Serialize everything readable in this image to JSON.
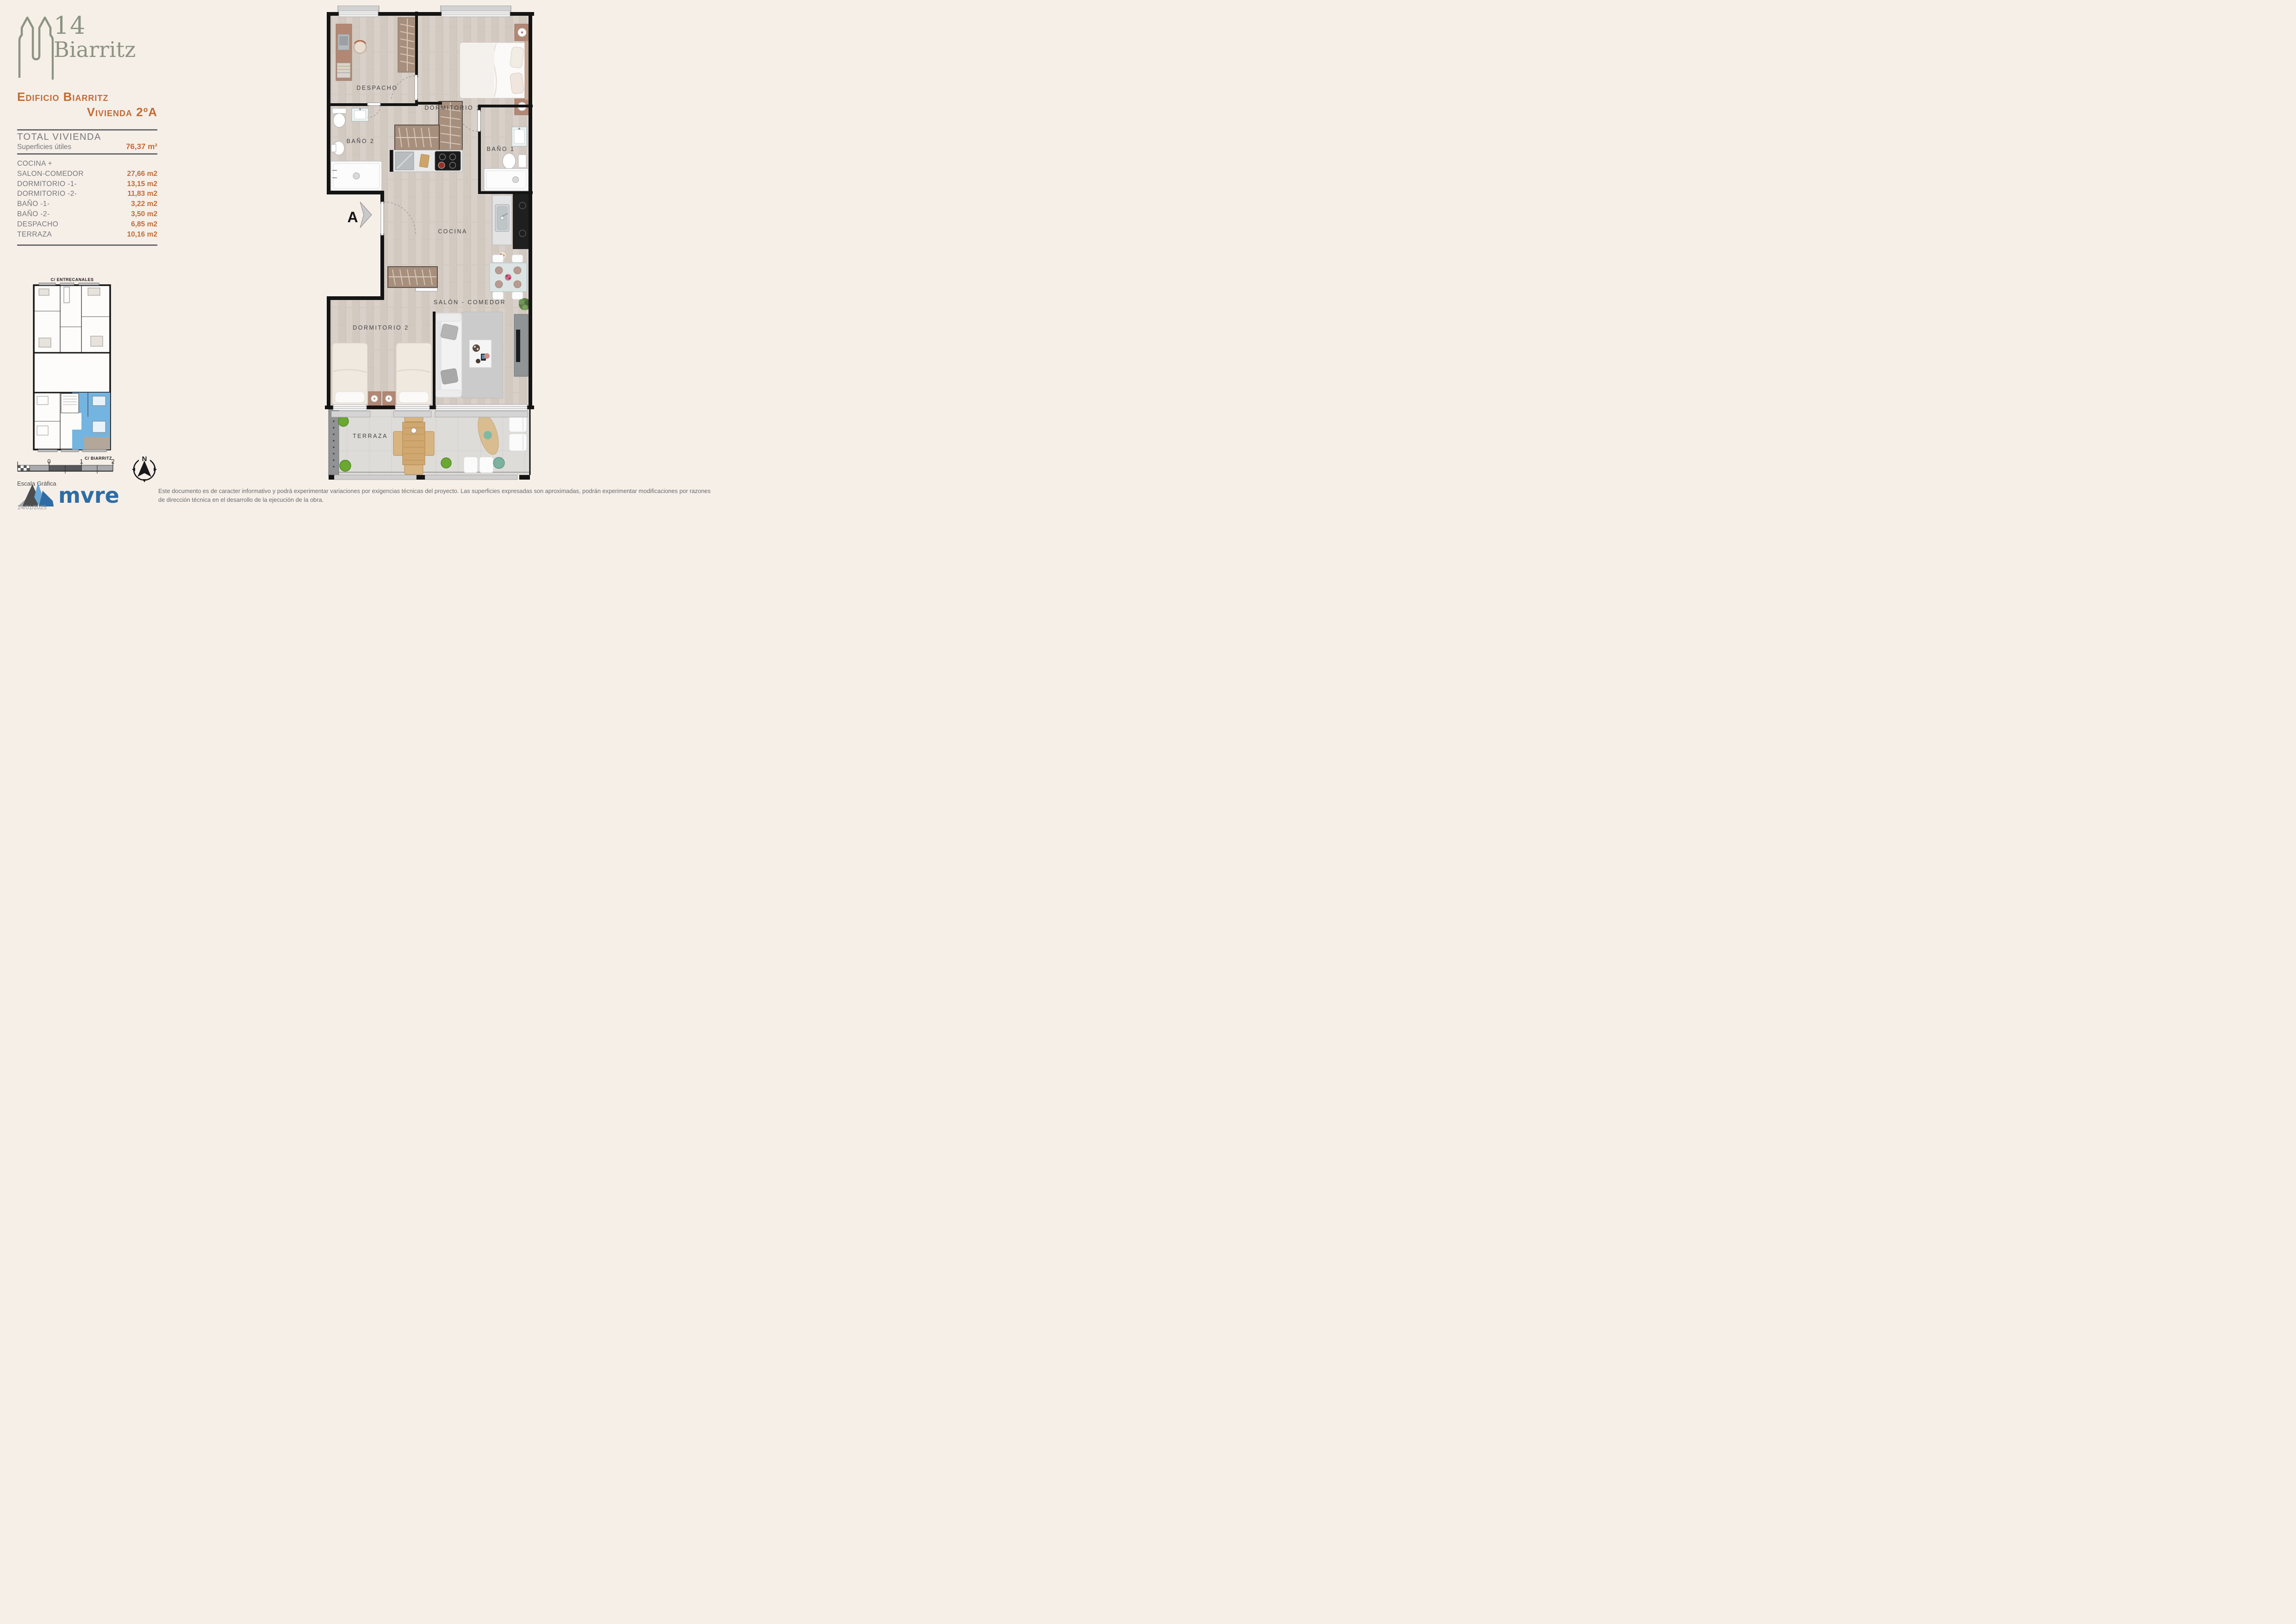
{
  "brand": {
    "number": "14",
    "name": "Biarritz",
    "color": "#8c9383"
  },
  "header": {
    "building": "Edificio Biarritz",
    "unit": "Vivienda 2ºA",
    "accent": "#c26b35"
  },
  "summary": {
    "title": "TOTAL VIVIENDA",
    "subtitle": "Superficies útiles",
    "total": "76,37 m²"
  },
  "areas": {
    "rows": [
      {
        "label": "COCINA +",
        "value": ""
      },
      {
        "label": "SALON-COMEDOR",
        "value": "27,66 m2"
      },
      {
        "label": "DORMITORIO -1-",
        "value": "13,15 m2"
      },
      {
        "label": "DORMITORIO -2-",
        "value": "11,83 m2"
      },
      {
        "label": "BAÑO -1-",
        "value": "3,22 m2"
      },
      {
        "label": "BAÑO -2-",
        "value": "3,50 m2"
      },
      {
        "label": "DESPACHO",
        "value": "6,85 m2"
      },
      {
        "label": "TERRAZA",
        "value": "10,16 m2"
      }
    ]
  },
  "key_plan": {
    "street_top": "C/ ENTRECANALES",
    "street_bottom": "C/ BIARRITZ",
    "highlight_color": "#74b4e0"
  },
  "scale_bar": {
    "label": "Escala Gráfica",
    "ticks": [
      "0",
      "1",
      "2"
    ]
  },
  "compass": {
    "north": "N"
  },
  "plan": {
    "entrance": "A",
    "rooms": {
      "despacho": "DESPACHO",
      "dormitorio1": "DORMITORIO 1",
      "bano2": "BAÑO 2",
      "bano1": "BAÑO 1",
      "cocina": "COCINA",
      "salon": "SALÓN - COMEDOR",
      "dormitorio2": "DORMITORIO 2",
      "terraza": "TERRAZA"
    }
  },
  "footer": {
    "logo": "mvre",
    "date": "24/01/2025",
    "disclaimer": "Este documento es de caracter informativo y podrá experimentar variaciones por exigencias técnicas del proyecto. Las superficies expresadas son aproximadas, podrán experimentar modificaciones por razones de dirección técnica en el desarrollo de la ejecución de la obra."
  }
}
